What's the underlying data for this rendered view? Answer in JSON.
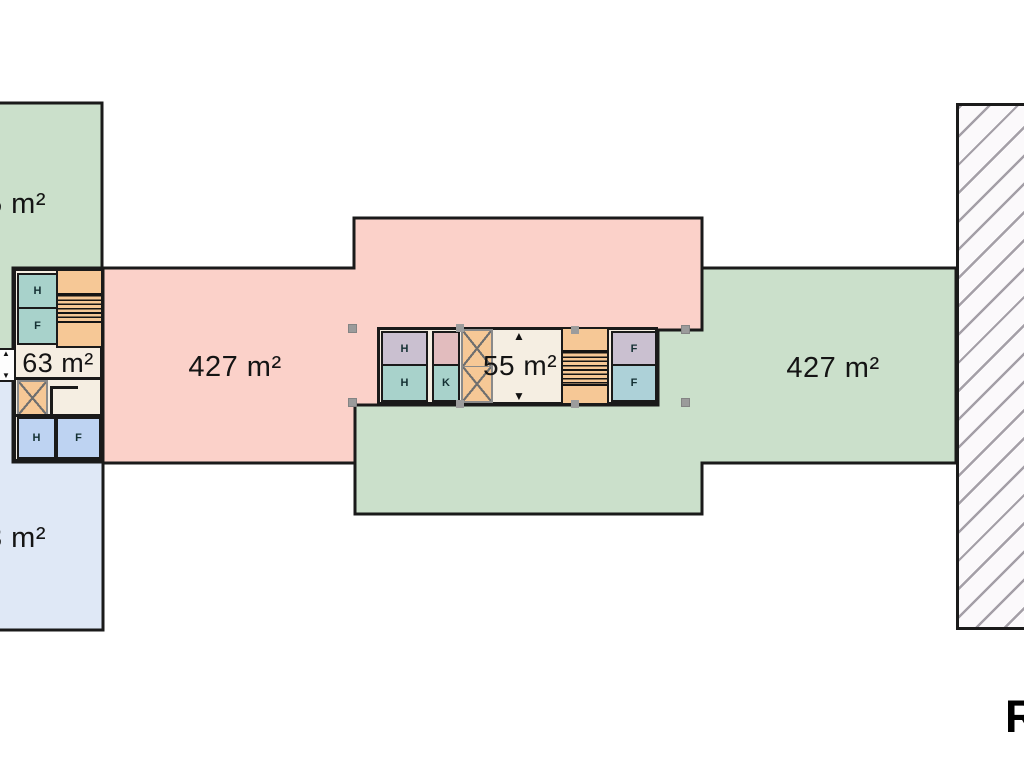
{
  "areas": {
    "top_left_apartment": {
      "label": "5 m²"
    },
    "bottom_left_apartment": {
      "label": "3 m²"
    },
    "left_wing": {
      "label": "427 m²"
    },
    "right_wing": {
      "label": "427 m²"
    },
    "left_core": {
      "label": "63 m²"
    },
    "center_core": {
      "label": "55 m²"
    }
  },
  "rooms": {
    "left_core": [
      "H",
      "F",
      "H",
      "F"
    ],
    "center_core": [
      "H",
      "H",
      "K",
      "F",
      "F"
    ]
  },
  "icons": {
    "up_arrow": "▲",
    "down_arrow": "▼"
  },
  "heading_fragment": "R",
  "colors": {
    "pink_wing": "#fbd1c9",
    "green_wing": "#cbe0cb",
    "blue_apartment": "#dfe8f6",
    "cream_core": "#f5eee2",
    "orange_stair": "#f6c896",
    "teal_room": "#a8d2cb",
    "mauve_room": "#cac0d0",
    "periwinkle_room": "#bed3f2",
    "small_pink_room": "#e2bcbe",
    "teal_blue_room": "#add1d8",
    "wall": "#1a1a1a",
    "hatch_line": "#a49fa7",
    "selection_handle": "#9b9b9b"
  }
}
